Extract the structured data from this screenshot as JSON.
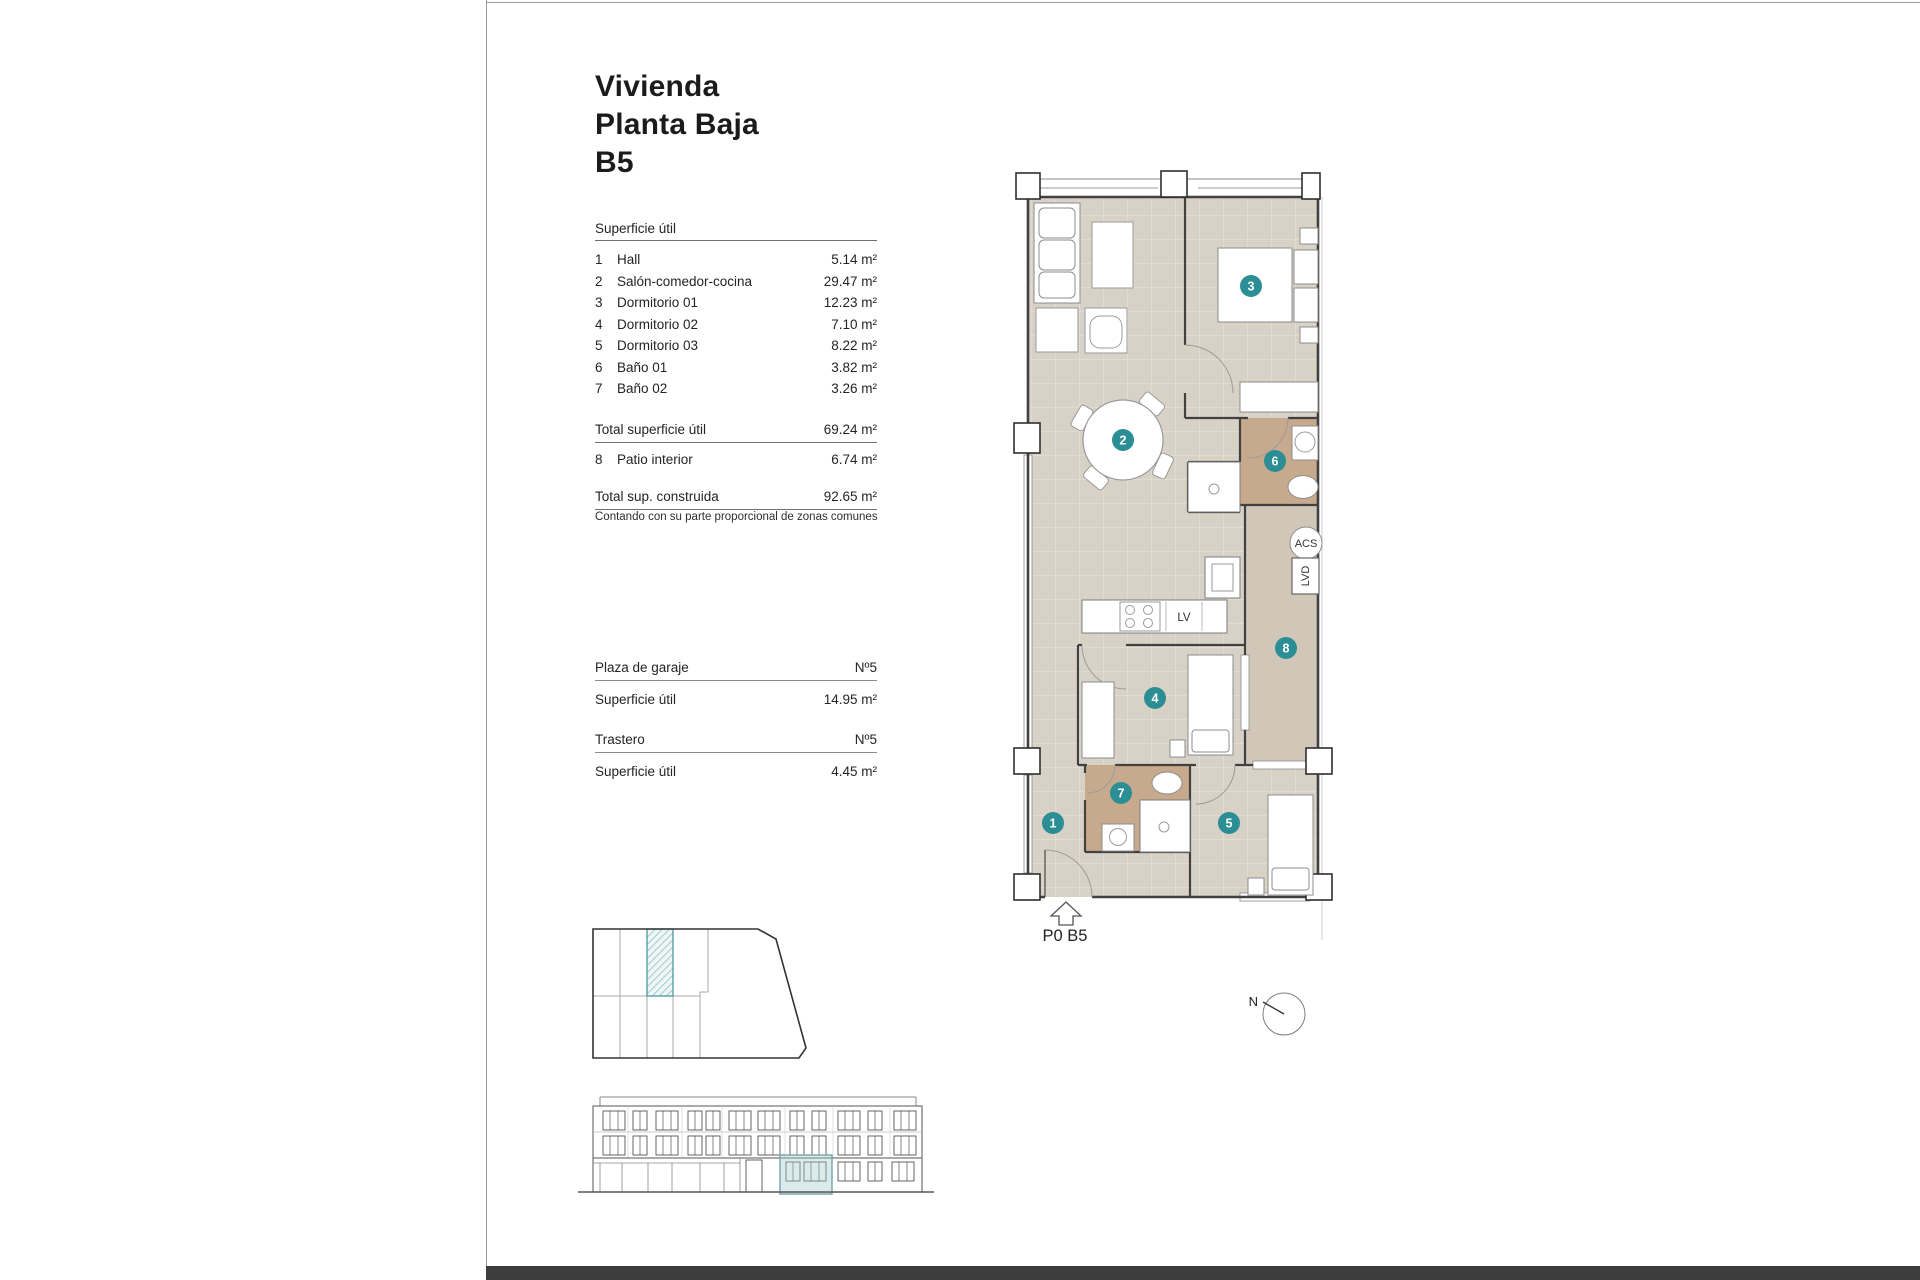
{
  "sheet": {
    "title_lines": [
      "Vivienda",
      "Planta Baja",
      "B5"
    ]
  },
  "surface_table": {
    "header": "Superficie útil",
    "rows": [
      {
        "num": "1",
        "label": "Hall",
        "value": "5.14 m²"
      },
      {
        "num": "2",
        "label": "Salón-comedor-cocina",
        "value": "29.47 m²"
      },
      {
        "num": "3",
        "label": "Dormitorio 01",
        "value": "12.23 m²"
      },
      {
        "num": "4",
        "label": "Dormitorio 02",
        "value": "7.10 m²"
      },
      {
        "num": "5",
        "label": "Dormitorio 03",
        "value": "8.22 m²"
      },
      {
        "num": "6",
        "label": "Baño 01",
        "value": "3.82 m²"
      },
      {
        "num": "7",
        "label": "Baño 02",
        "value": "3.26 m²"
      }
    ],
    "total_useful": {
      "label": "Total superficie útil",
      "value": "69.24 m²"
    },
    "patio_row": {
      "num": "8",
      "label": "Patio interior",
      "value": "6.74 m²"
    },
    "total_built": {
      "label": "Total sup. construida",
      "value": "92.65 m²"
    },
    "note": "Contando con su parte proporcional de zonas comunes"
  },
  "garage": {
    "label": "Plaza de garaje",
    "number": "Nº5",
    "area_label": "Superficie útil",
    "area_value": "14.95 m²"
  },
  "storage": {
    "label": "Trastero",
    "number": "Nº5",
    "area_label": "Superficie útil",
    "area_value": "4.45 m²"
  },
  "floor_plan": {
    "unit_label": "P0 B5",
    "room_numbers": [
      "1",
      "2",
      "3",
      "4",
      "5",
      "6",
      "7",
      "8"
    ],
    "equipment_labels": {
      "acs": "ACS",
      "lvd": "LVD",
      "dishwasher": "LV"
    },
    "colors": {
      "floor": "#d8d1c6",
      "wet_floor": "#c7aa8d",
      "patio_floor": "#d1c7b8",
      "marker": "#2c8e95"
    }
  },
  "compass": {
    "north": "N"
  }
}
